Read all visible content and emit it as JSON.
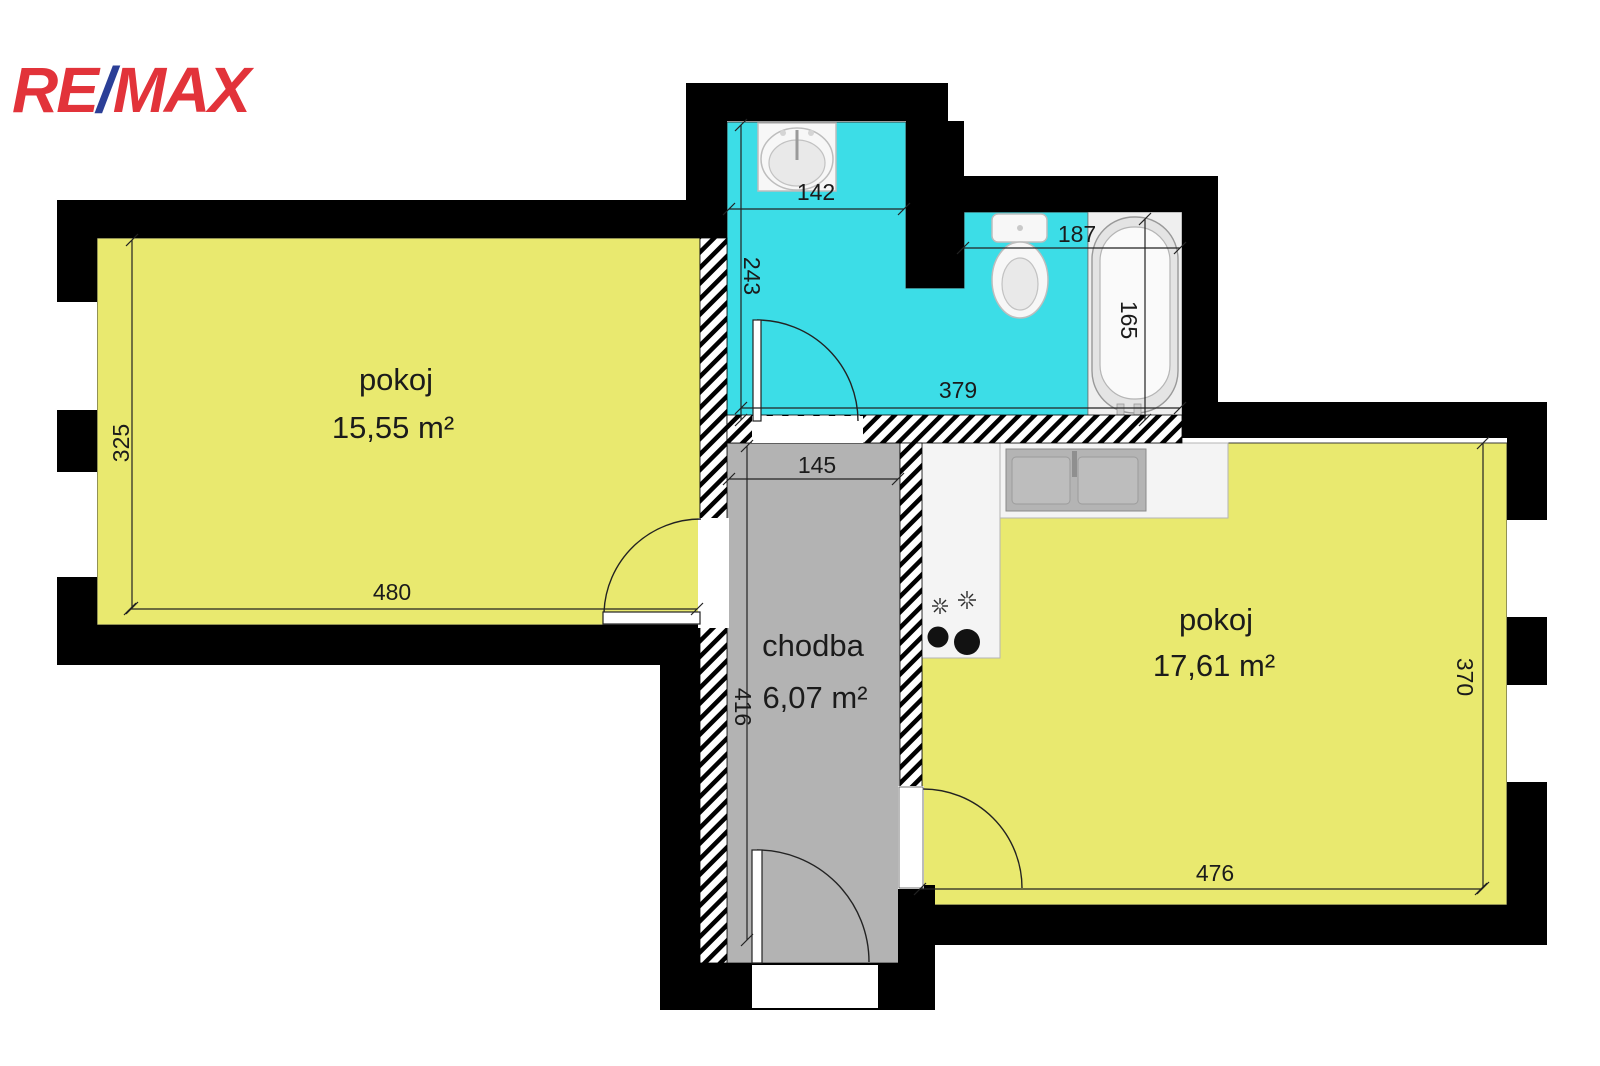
{
  "logo": {
    "re": "RE",
    "slash": "/",
    "max": "MAX"
  },
  "colors": {
    "logo_red": "#e2333a",
    "logo_blue": "#2b3f97",
    "room_fill": "#e9e96f",
    "bath_fill": "#3cdde7",
    "corridor_fill": "#b3b3b3",
    "fixture_area": "#efefef",
    "wall": "#000000"
  },
  "rooms": {
    "room_left": {
      "name": "pokoj",
      "area": "15,55 m²"
    },
    "corridor": {
      "name": "chodba",
      "area": "6,07 m²"
    },
    "room_right": {
      "name": "pokoj",
      "area": "17,61 m²"
    }
  },
  "dimensions_cm": {
    "room_left_height": "325",
    "room_left_width": "480",
    "bath_sink_width": "142",
    "bath_sink_depth": "243",
    "bath_wc_width": "187",
    "bath_tub_length": "165",
    "bath_total_width": "379",
    "corridor_width": "145",
    "corridor_length": "416",
    "room_right_depth": "370",
    "room_right_width": "476"
  }
}
